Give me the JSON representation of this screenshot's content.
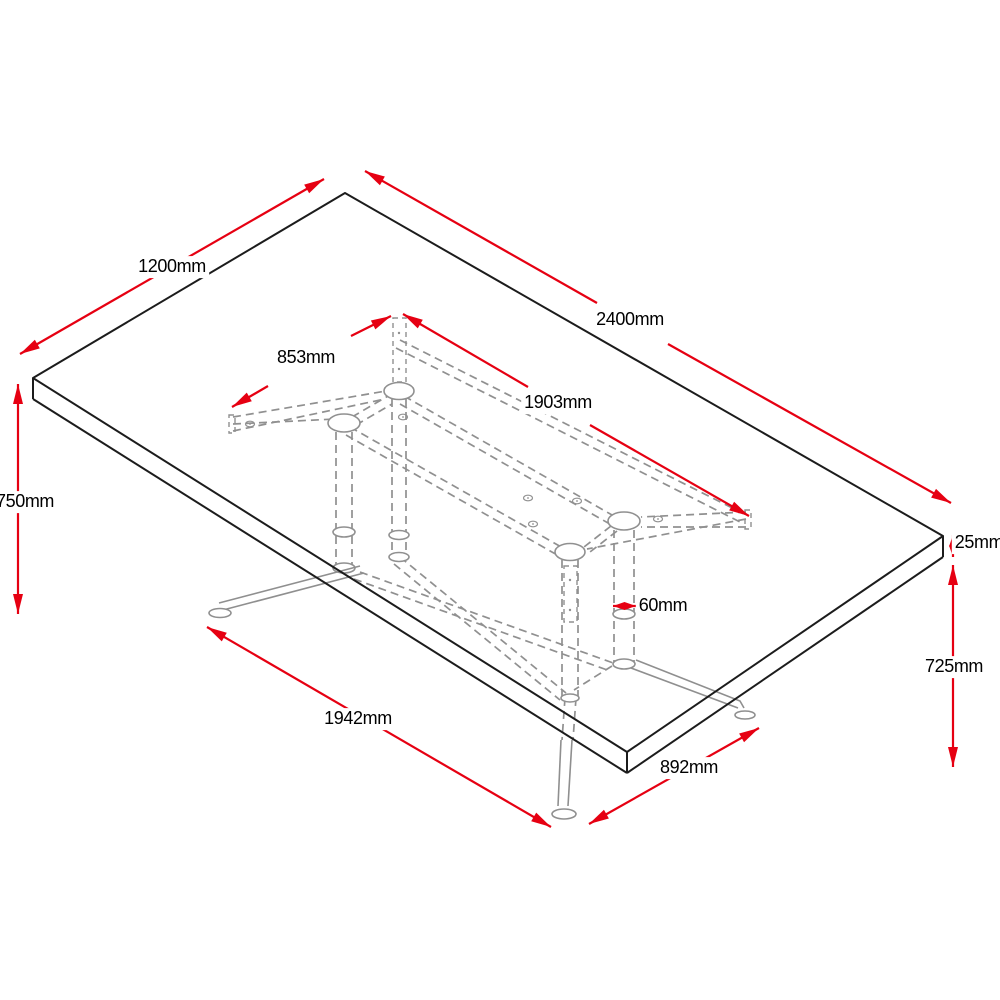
{
  "drawing": {
    "type": "isometric dimension drawing",
    "subject": "rectangular table top with twin pedestal wireframe base",
    "unit": "mm",
    "background": "#ffffff",
    "colors": {
      "dimension_red": "#e60012",
      "edge_black": "#1c1c1c",
      "hidden_gray": "#909090"
    },
    "dimensions": {
      "top_width": "1200mm",
      "top_length": "2400mm",
      "base_frame_width": "853mm",
      "base_frame_length": "1903mm",
      "overall_height": "750mm",
      "top_thickness": "25mm",
      "clearance_height": "725mm",
      "column_diameter": "60mm",
      "foot_span_length": "1942mm",
      "foot_span_width": "892mm"
    }
  }
}
